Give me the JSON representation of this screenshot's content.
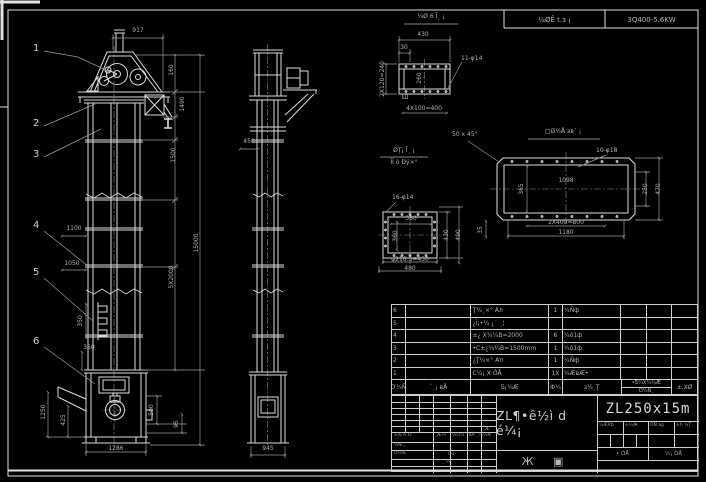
{
  "top_header": {
    "cell1": "¼ØÊ t.з ¡",
    "cell2": "3Q400-5.6KW"
  },
  "front_view": {
    "balloon1": "1",
    "balloon2": "2",
    "balloon3": "3",
    "balloon4": "4",
    "balloon5": "5",
    "balloon6": "6",
    "dim_917": "917",
    "dim_160": "160",
    "dim_1490": "1490",
    "dim_1500": "1500",
    "dim_5x2000": "5X2000",
    "dim_15000": "15000",
    "dim_1100": "1100",
    "dim_1050": "1050",
    "dim_350a": "350",
    "dim_350b": "350",
    "dim_1250": "1250",
    "dim_425": "425",
    "dim_500": "500",
    "dim_95": "95",
    "dim_1286": "1286"
  },
  "side_view": {
    "dim_450": "450",
    "dim_945": "945"
  },
  "detail_top": {
    "title": "¼Ø 6 Ī¸ ¡",
    "dim_430": "430",
    "dim_30": "30",
    "dim_240": "2X120=240",
    "dim_400": "4X100=400",
    "dim_260": "260",
    "callout": "11-φ14",
    "mark": "Ш"
  },
  "detail_square": {
    "title1": "ØŢ¡ Ī¸ ¡",
    "title2": "ĪĬ ò Đý×°",
    "callout": "16-φ14",
    "dim_380": "380",
    "dim_360": "360",
    "dim_430": "430",
    "dim_490": "490",
    "dim_b1": "φ216.3=430",
    "dim_b2": "480"
  },
  "detail_long": {
    "title": "□Ø½Å эвˊ ¡",
    "chamfer": "50 x 45°",
    "callout": "10-φ18",
    "dim_1098": "1098",
    "dim_365": "365",
    "dim_250": "250",
    "dim_470": "470",
    "dim_b1": "2X400=800",
    "dim_b2": "1180",
    "dim_35": "35"
  },
  "bom": {
    "h_no": "Ơ¼Ñ",
    "h_code": "ˊ¸¡ вÅ",
    "h_name": "Ƽ¡¾Æ",
    "h_qty": "Ф¼",
    "h_mat": "з¼¸Ţ",
    "h_wt_top": "•Ƽ¼X¼¾Æ",
    "h_wt_bot": "Ó¼Ñ¸",
    "h_rem": "±,XØ",
    "rows": [
      {
        "no": "6",
        "code": "",
        "name": "Ţ¼¸×° Ал",
        "qty": "1",
        "mat": "¼Ñф"
      },
      {
        "no": "5",
        "code": "",
        "name": "¿Ì¡•¼ ¿ˊ ¸¦",
        "qty": "",
        "mat": ""
      },
      {
        "no": "4",
        "code": "",
        "name": "±¿ X¾¼В=2000",
        "qty": "6",
        "mat": "¼ô1ф"
      },
      {
        "no": "3",
        "code": "",
        "name": "•С±¿¾¼В=1500mm",
        "qty": "1",
        "mat": "¼ô1ф"
      },
      {
        "no": "2",
        "code": "",
        "name": "¿Ţ¼×° Ал",
        "qty": "1",
        "mat": "¼Ñф"
      },
      {
        "no": "1",
        "code": "",
        "name": "С¼¡ X ÓÅ",
        "qty": "1X",
        "mat": "¼ÆвÆ•"
      }
    ]
  },
  "title_block": {
    "rev1": "±Æ¼ Ó",
    "rev2": "¸Æ¼",
    "rev3": "¼Ó¼",
    "rev4": "вÅ ¸¼",
    "rev5": "¼Ñ",
    "rev6": "¸Æ",
    "sig1": "¼Ñ ¸",
    "sig2": "Ó¼Æ",
    "sig3": "Óü",
    "sig4": "¸ ¼¸",
    "title": "ZL¶•ê½ì d é¼¡",
    "subtitle": "Ж ▣",
    "model": "ZL250x15m",
    "st1": "¼ÆRb",
    "st2": "±¼Ж",
    "st3": "ÓÑ вg",
    "st4": "±h ¼Ţ",
    "sh1": "• ÓÅ",
    "sh2": "¼¡ ÓÅ"
  }
}
